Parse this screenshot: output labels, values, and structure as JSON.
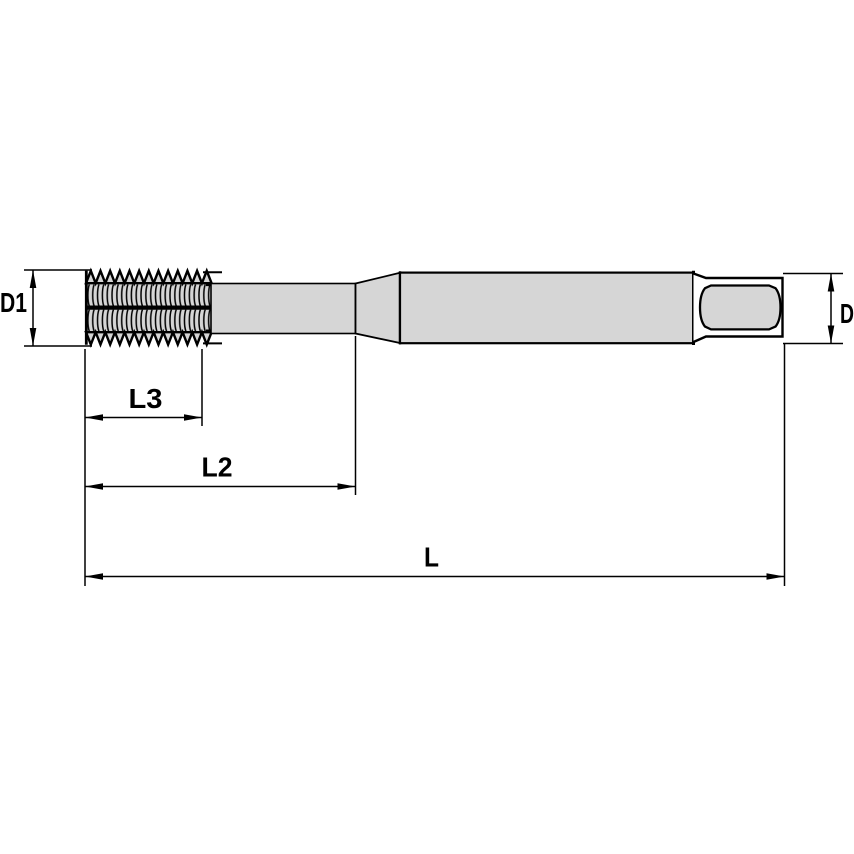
{
  "drawing": {
    "type": "technical-drawing-tap-side-view",
    "labels": {
      "d1": "D1",
      "d": "D",
      "l3": "L3",
      "l2": "L2",
      "l": "L"
    },
    "colors": {
      "body_fill": "#d6d6d6",
      "line": "#000000",
      "background": "#ffffff"
    }
  }
}
